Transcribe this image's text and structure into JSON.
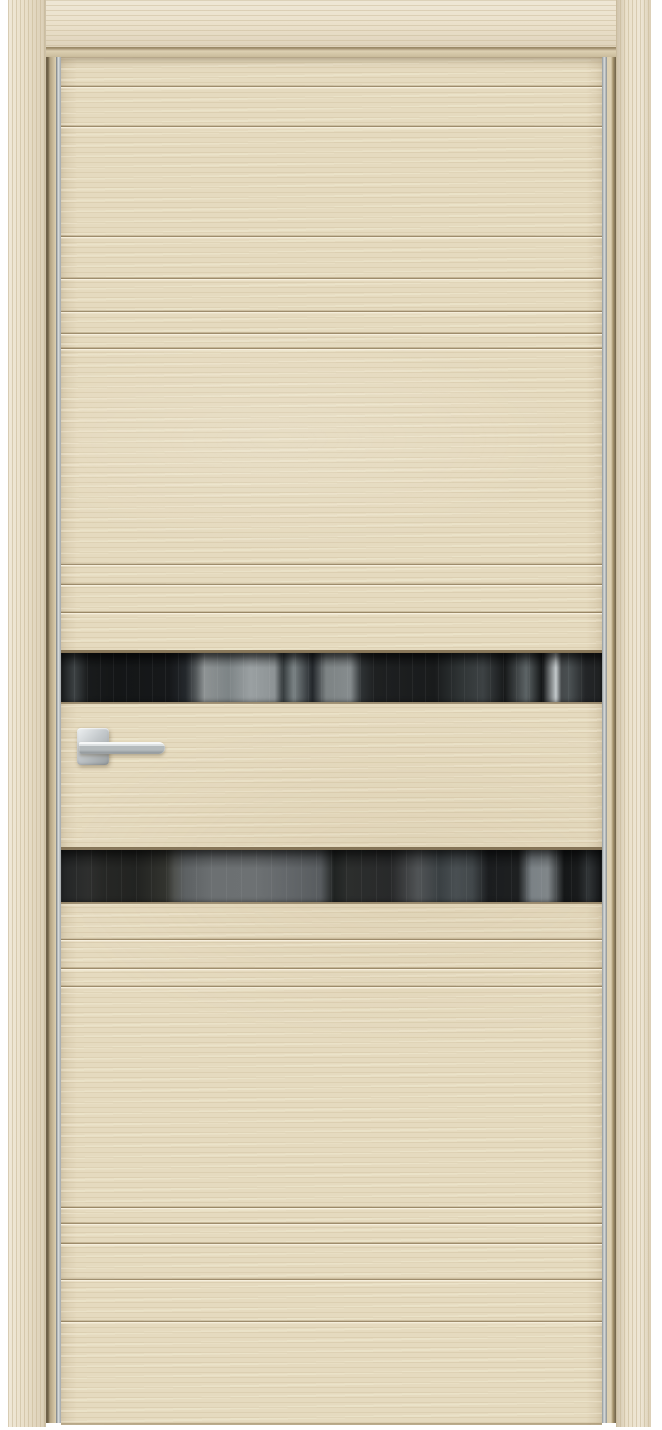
{
  "image": {
    "subject": "interior door product photo",
    "finish": "light oak laminate with horizontal milled grooves",
    "features": [
      "two full-width dark tinted glass strips with room reflections",
      "square-rosette chrome lever handle on left side",
      "aluminum vertical edge strips",
      "light oak door frame with casings"
    ]
  },
  "colors": {
    "page_bg": "#ffffff",
    "wood_base": "#e5dabf",
    "wood_grain": "#cdbc98",
    "wood_light": "#f0e8d2",
    "casing_base": "#eae0ca",
    "groove_dark": "#7d6844",
    "groove_light": "#f4ecd8",
    "silver_edge": "#c9cccc",
    "glass_dark": "#17191a",
    "glass_reflection": "#7d8486",
    "handle_metal": "#c7cbce",
    "frame_shadow": "#6f6148"
  },
  "door": {
    "groove_offsets_px": [
      28,
      68,
      178,
      220,
      253,
      275,
      290,
      506,
      526,
      554,
      881,
      910,
      928,
      1149,
      1165,
      1185,
      1221,
      1263
    ],
    "glass_strips": [
      {
        "top_px": 596,
        "height_px": 49
      },
      {
        "top_px": 793,
        "height_px": 52
      }
    ]
  }
}
